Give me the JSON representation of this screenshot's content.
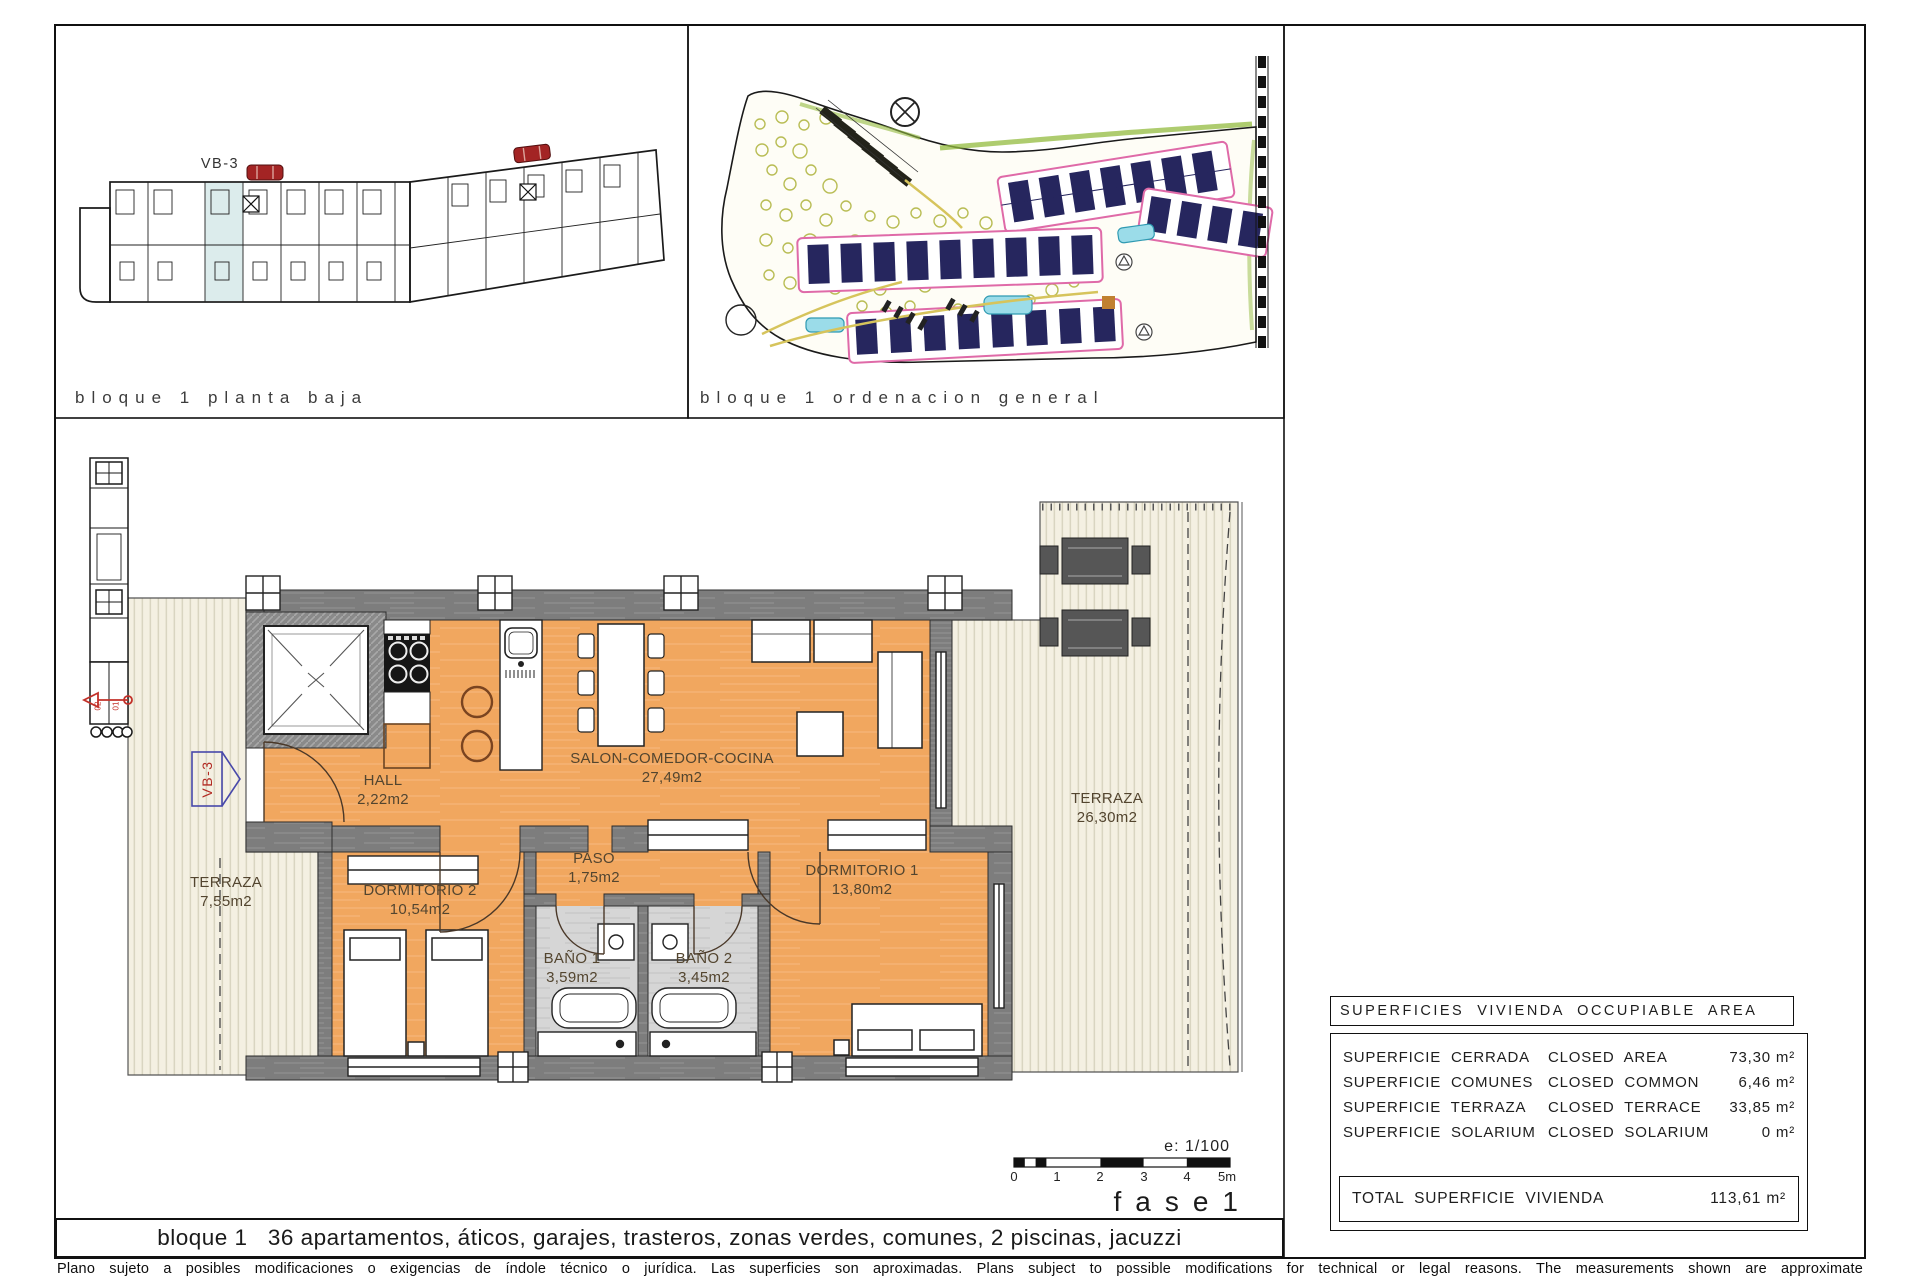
{
  "sheet": {
    "panel_floor": {
      "caption": "bloque 1 planta baja",
      "unit_code": "VB-3"
    },
    "panel_site": {
      "caption": "bloque 1 ordenacion general"
    },
    "plan": {
      "unit_tag": "VB-3",
      "core_labels": [
        "02",
        "01"
      ],
      "rooms": [
        {
          "name": "HALL",
          "area": "2,22m2"
        },
        {
          "name": "SALON-COMEDOR-COCINA",
          "area": "27,49m2"
        },
        {
          "name": "PASO",
          "area": "1,75m2"
        },
        {
          "name": "DORMITORIO 2",
          "area": "10,54m2"
        },
        {
          "name": "DORMITORIO 1",
          "area": "13,80m2"
        },
        {
          "name": "BAÑO 1",
          "area": "3,59m2"
        },
        {
          "name": "BAÑO 2",
          "area": "3,45m2"
        },
        {
          "name": "TERRAZA",
          "area": "26,30m2"
        },
        {
          "name": "TERRAZA",
          "area": "7,55m2"
        }
      ]
    },
    "scale_block": {
      "scale_text": "e: 1/100",
      "ticks": [
        "0",
        "1",
        "2",
        "3",
        "4",
        "5m"
      ],
      "phase": "fase1"
    },
    "areas_table": {
      "title": "SUPERFICIES  VIVIENDA  OCCUPIABLE  AREA",
      "rows": [
        {
          "es": "SUPERFICIE  CERRADA",
          "en": "CLOSED  AREA",
          "value": "73,30 m²"
        },
        {
          "es": "SUPERFICIE  COMUNES",
          "en": "CLOSED  COMMON",
          "value": "6,46 m²"
        },
        {
          "es": "SUPERFICIE  TERRAZA",
          "en": "CLOSED  TERRACE",
          "value": "33,85 m²"
        },
        {
          "es": "SUPERFICIE  SOLARIUM",
          "en": "CLOSED  SOLARIUM",
          "value": "0 m²"
        }
      ],
      "total_label": "TOTAL  SUPERFICIE  VIVIENDA",
      "total_value": "113,61 m²"
    },
    "footer": {
      "caption": "bloque 1   36 apartamentos, áticos, garajes, trasteros, zonas verdes, comunes, 2 piscinas, jacuzzi",
      "disclaimer": "Plano sujeto a posibles modificaciones o exigencias de índole técnico o jurídica. Las superficies son aproximadas. Plans subject to possible modifications for technical or legal reasons. The measurements shown are approximate"
    },
    "colors": {
      "floor_orange": "#f1a75f",
      "wall_gray": "#7d7d7d",
      "highlight_blue": "#dcecec",
      "accent_red": "#c23028",
      "tag_blue": "#4848aa",
      "site_pink": "#df6aa8",
      "site_navy": "#26265e"
    }
  }
}
